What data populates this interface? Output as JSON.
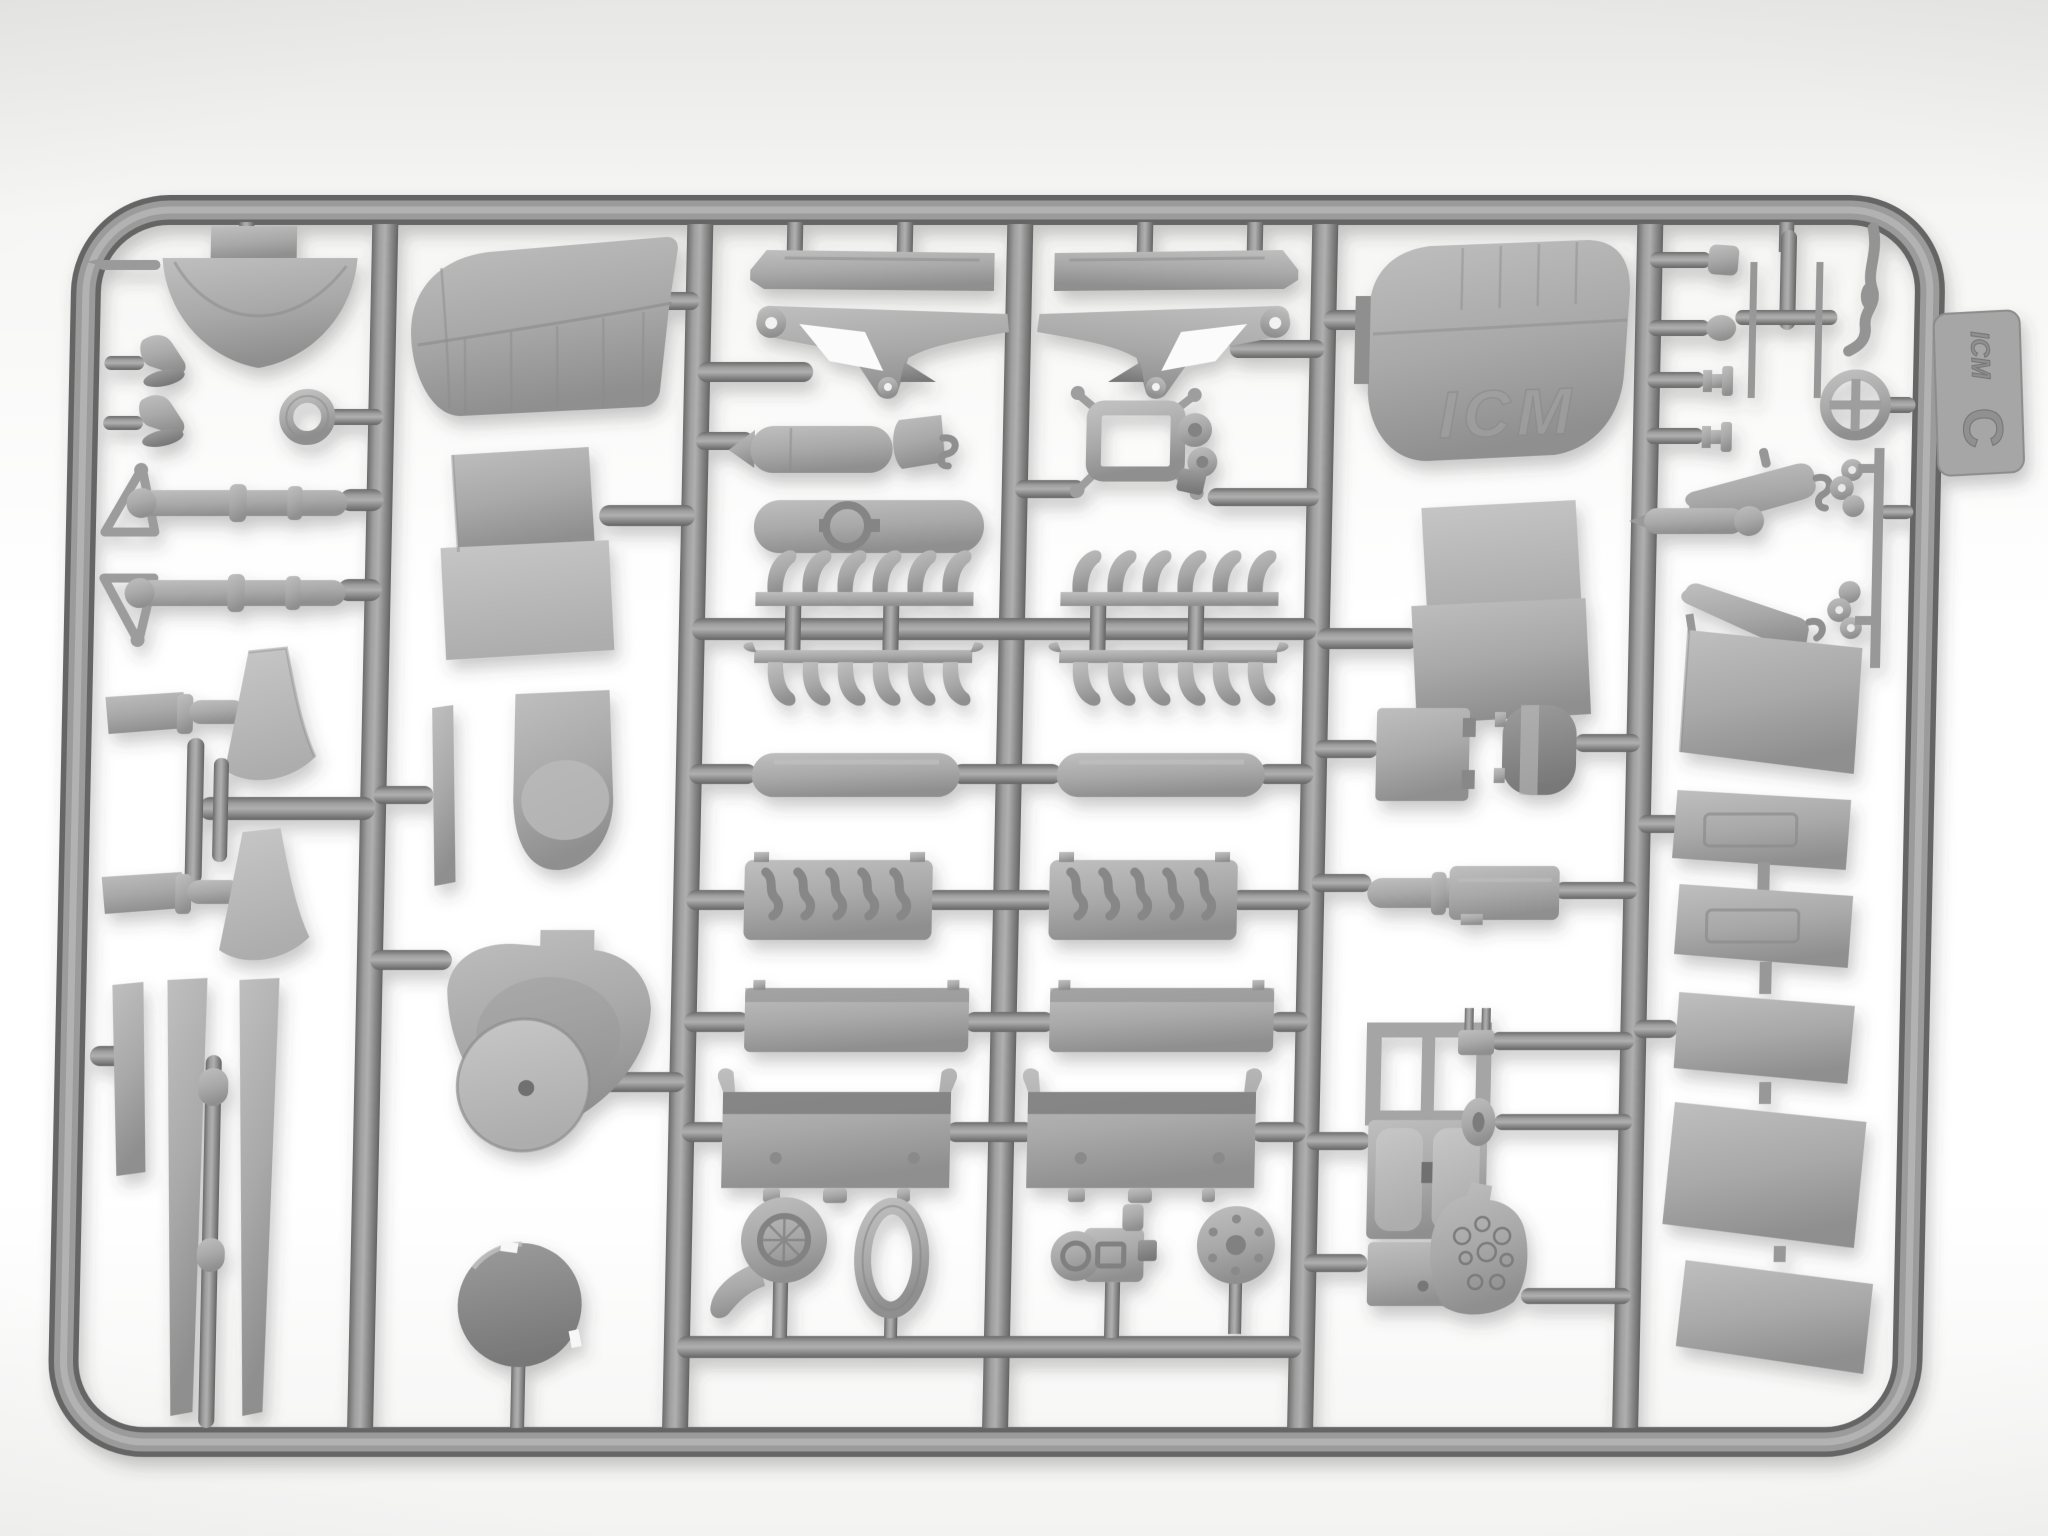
{
  "scene": {
    "description": "Photograph of a light-gray injection-molded plastic model aircraft sprue on a white background",
    "brand": "ICM",
    "sprue_letter": "C",
    "wing_embossing": "ICM",
    "colors": {
      "plastic_light": "#bcbcbc",
      "plastic_mid": "#a2a2a2",
      "plastic_shadow": "#8a8a8a",
      "runner_dark": "#676767",
      "background": "#ffffff"
    }
  },
  "tag": {
    "brand": "ICM",
    "letter": "C"
  },
  "frame": {
    "columns": 6,
    "vertical_runners_x": [
      390,
      705,
      1025,
      1330,
      1655
    ]
  },
  "parts": {
    "column_1": [
      "cowl-bowl",
      "pitot-pin",
      "rudder-pedal",
      "rudder-pedal",
      "eyelet-ring",
      "bracing-strut-rod",
      "bracing-strut-rod",
      "windscreen-fan",
      "cabane-strut-pair",
      "windscreen-fan",
      "ski-strip",
      "tapered-ski",
      "tapered-ski",
      "strut-rod-with-collars"
    ],
    "column_2": [
      "wingtip-panel",
      "cowl-panel-pair",
      "thin-strip",
      "fuselage-belly-panel",
      "cowl-front-shield",
      "wheel-disc",
      "spinner-dome"
    ],
    "column_3": [
      "engine-bearer-rail",
      "v-strut-bracket",
      "bomb-fairing",
      "support-bracket",
      "valve-cover-panel",
      "exhaust-stack-row",
      "exhaust-stack-row",
      "cylinder-capsule",
      "crankcase-with-rods",
      "valve-box",
      "crankcase-half",
      "supercharger-volute",
      "oval-gasket-ring"
    ],
    "column_4": [
      "engine-bearer-rail",
      "v-strut-bracket",
      "engine-mount-frame",
      "exhaust-stack-row",
      "exhaust-stack-row",
      "cylinder-capsule",
      "crankcase-with-rods",
      "valve-box",
      "crankcase-half",
      "magneto-pump",
      "bolt-flange-disc"
    ],
    "column_5": [
      "upper-wing-panel",
      "cowl-side-panel-pair",
      "access-hatch-plate",
      "curved-drum-segment",
      "cylinder-and-box",
      "cockpit-tub-with-seats",
      "pronged-bracket",
      "oval-grommet",
      "instrument-panel"
    ],
    "column_6": [
      "knob-pin",
      "knob-pin",
      "spool-pin",
      "spool-pin",
      "h-strut-assembly",
      "bent-whip-rod",
      "control-wheel",
      "float-blade",
      "float-blade",
      "capsule-rod",
      "clover-fitting",
      "clover-fitting",
      "aileron-panel-large",
      "aileron-panel-inset",
      "aileron-panel-inset",
      "elevator-panel",
      "elevator-panel-wide",
      "elevator-panel-corner"
    ]
  }
}
